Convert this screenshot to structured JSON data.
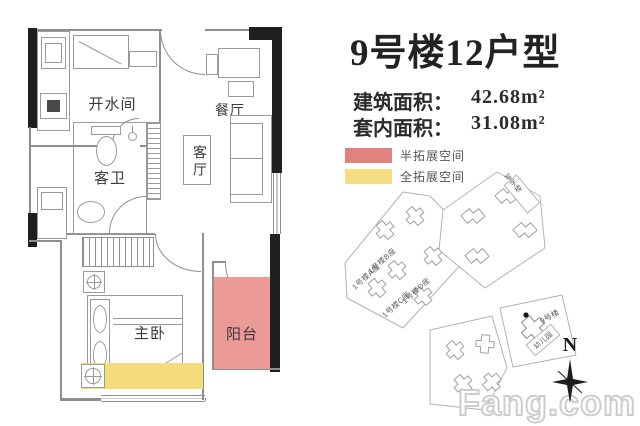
{
  "header": {
    "title": "9号楼12户型",
    "specs": [
      {
        "label": "建筑面积：",
        "value": "42.68m²"
      },
      {
        "label": "套内面积：",
        "value": "31.08m²"
      }
    ]
  },
  "legend": {
    "items": [
      {
        "label": "半拓展空间",
        "color": "#e0827e"
      },
      {
        "label": "全拓展空间",
        "color": "#f6dd82"
      }
    ]
  },
  "floorplan": {
    "rooms": {
      "kitchen": "开水间",
      "dining": "餐厅",
      "bathroom": "客卫",
      "living": "客厅",
      "bedroom": "主卧",
      "balcony": "阳台"
    },
    "colors": {
      "balcony_fill": "#eb9a96",
      "extend_fill": "#f5db7a"
    }
  },
  "sitemap": {
    "labels": {
      "b1a": "1号楼A座",
      "b1b": "1号楼B座",
      "b1c": "1号楼C座",
      "b1d": "1号楼D座",
      "office": "写字楼",
      "b9": "9号楼",
      "kindergarten": "幼儿园"
    }
  },
  "compass": {
    "north": "N"
  },
  "watermark": {
    "text": "Fang.com"
  }
}
